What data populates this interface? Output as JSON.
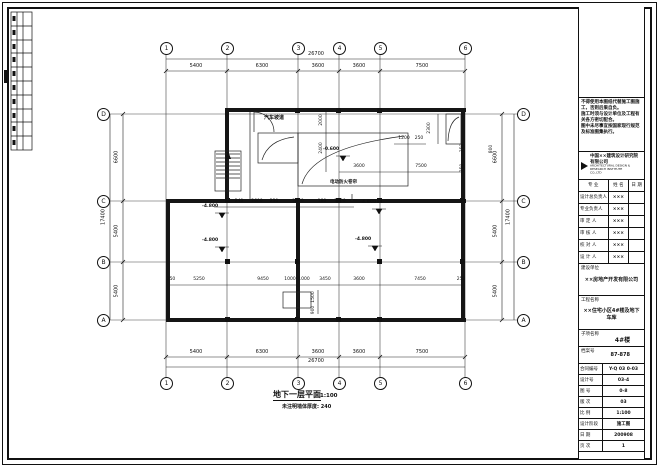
{
  "drawing": {
    "title": "地下一层平面",
    "scale": "1:100",
    "note": "未注明墙体厚度: 240",
    "axes": {
      "cols": [
        "1",
        "2",
        "3",
        "4",
        "5",
        "6"
      ],
      "rows": [
        "D",
        "C",
        "B",
        "A"
      ],
      "col_dims": [
        "5400",
        "6300",
        "3600",
        "3600",
        "7500"
      ],
      "col_total": "26700",
      "row_dims": [
        "6600",
        "5400",
        "5400"
      ],
      "row_total": "17400"
    },
    "dims": {
      "upper": [
        "240",
        "2600",
        "230",
        "3050",
        "180",
        "2400"
      ],
      "upper_right": [
        "3600",
        "7500"
      ],
      "lower": [
        "250",
        "5250",
        "9450",
        "1000",
        "1000",
        "3450",
        "3600",
        "7450",
        "250"
      ],
      "ramp_height": "2300",
      "ramp_w1": "1200",
      "ramp_w2": "250",
      "pit_a": "1500",
      "pit_b": "900",
      "side": [
        "2000",
        "2400",
        "250",
        "250",
        "800"
      ]
    },
    "levels": {
      "garage": "-4.800",
      "ramp": "-0.600"
    },
    "labels": {
      "ramp": "汽车坡道",
      "curtain": "电动防火卷帘"
    }
  },
  "titleblock": {
    "notes": [
      "不得使用本图纸代替施工图施工，否则后果自负。",
      "施工时须与设计单位及工程有关各方密切配合。",
      "图中未尽事宜按国家现行规范及标准图集执行。"
    ],
    "company": "中国××建筑设计研究院有限公司",
    "company_sub": "ARCHITECTURAL DESIGN & RESEARCH INSTITUTE CO.,LTD",
    "cols": [
      "专 业",
      "姓 名",
      "日 期"
    ],
    "sign_rows": [
      {
        "label": "设计总负责人",
        "value": "×××"
      },
      {
        "label": "专业负责人",
        "value": "×××"
      },
      {
        "label": "审 定 人",
        "value": "×××"
      },
      {
        "label": "审 核 人",
        "value": "×××"
      },
      {
        "label": "校 对 人",
        "value": "×××"
      },
      {
        "label": "设 计 人",
        "value": "×××"
      }
    ],
    "client_label": "建设单位",
    "client": "××房地产开发有限公司",
    "project_label": "工程名称",
    "project": "××住宅小区4#楼及地下车库",
    "subitem_label": "子项名称",
    "subitem": "4#楼",
    "archive_label": "档案号",
    "archive": "87-878",
    "rows": [
      {
        "label": "合同编号",
        "value": "Y-Q 03 0-03"
      },
      {
        "label": "设计号",
        "value": "03-4"
      },
      {
        "label": "图 号",
        "value": "0-8"
      },
      {
        "label": "版 次",
        "value": "03"
      },
      {
        "label": "比 例",
        "value": "1:100"
      },
      {
        "label": "设计阶段",
        "value": "施工图"
      },
      {
        "label": "日 期",
        "value": "200908"
      },
      {
        "label": "页 次",
        "value": "1"
      }
    ]
  }
}
